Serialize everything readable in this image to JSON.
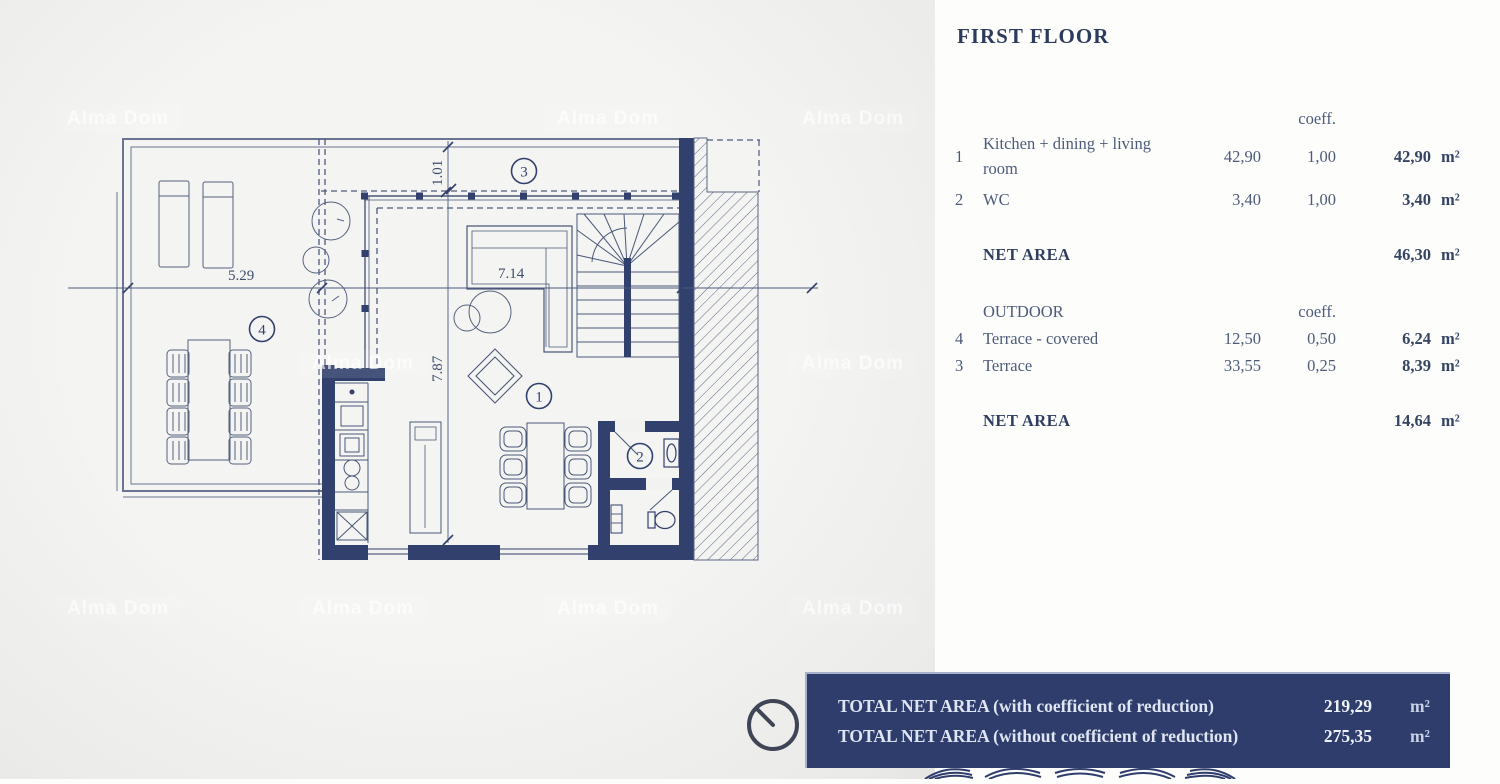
{
  "title": "FIRST FLOOR",
  "table": {
    "coeff_header": "coeff.",
    "indoor_rows": [
      {
        "num": "1",
        "label": "Kitchen + dining + living room",
        "area": "42,90",
        "coeff": "1,00",
        "total": "42,90",
        "unit": "m²"
      },
      {
        "num": "2",
        "label": "WC",
        "area": "3,40",
        "coeff": "1,00",
        "total": "3,40",
        "unit": "m²"
      }
    ],
    "net_indoor": {
      "label": "NET AREA",
      "total": "46,30",
      "unit": "m²"
    },
    "outdoor_header": {
      "label": "OUTDOOR",
      "coeff": "coeff."
    },
    "outdoor_rows": [
      {
        "num": "4",
        "label": "Terrace - covered",
        "area": "12,50",
        "coeff": "0,50",
        "total": "6,24",
        "unit": "m²"
      },
      {
        "num": "3",
        "label": "Terrace",
        "area": "33,55",
        "coeff": "0,25",
        "total": "8,39",
        "unit": "m²"
      }
    ],
    "net_outdoor": {
      "label": "NET AREA",
      "total": "14,64",
      "unit": "m²"
    }
  },
  "totals": {
    "with_reduction": {
      "label": "TOTAL NET AREA (with coefficient of reduction)",
      "value": "219,29",
      "unit": "m²"
    },
    "without_reduction": {
      "label": "TOTAL NET AREA (without coefficient of reduction)",
      "value": "275,35",
      "unit": "m²"
    }
  },
  "plan": {
    "dimensions": {
      "terrace_width": "5.29",
      "room_width": "7.14",
      "overhang_depth": "1.01",
      "room_depth": "7.87"
    },
    "room_markers": {
      "living": "1",
      "wc": "2",
      "terrace": "3",
      "terrace_covered": "4"
    }
  },
  "watermark": "Alma Dom",
  "colors": {
    "wall_navy": "#32406d",
    "thin_line": "#5b6687",
    "bar_navy": "#2e3d6b",
    "text_navy": "#2c3a5e",
    "plan_bg": "#f2f2f0",
    "panel_bg": "#fdfdfc"
  }
}
